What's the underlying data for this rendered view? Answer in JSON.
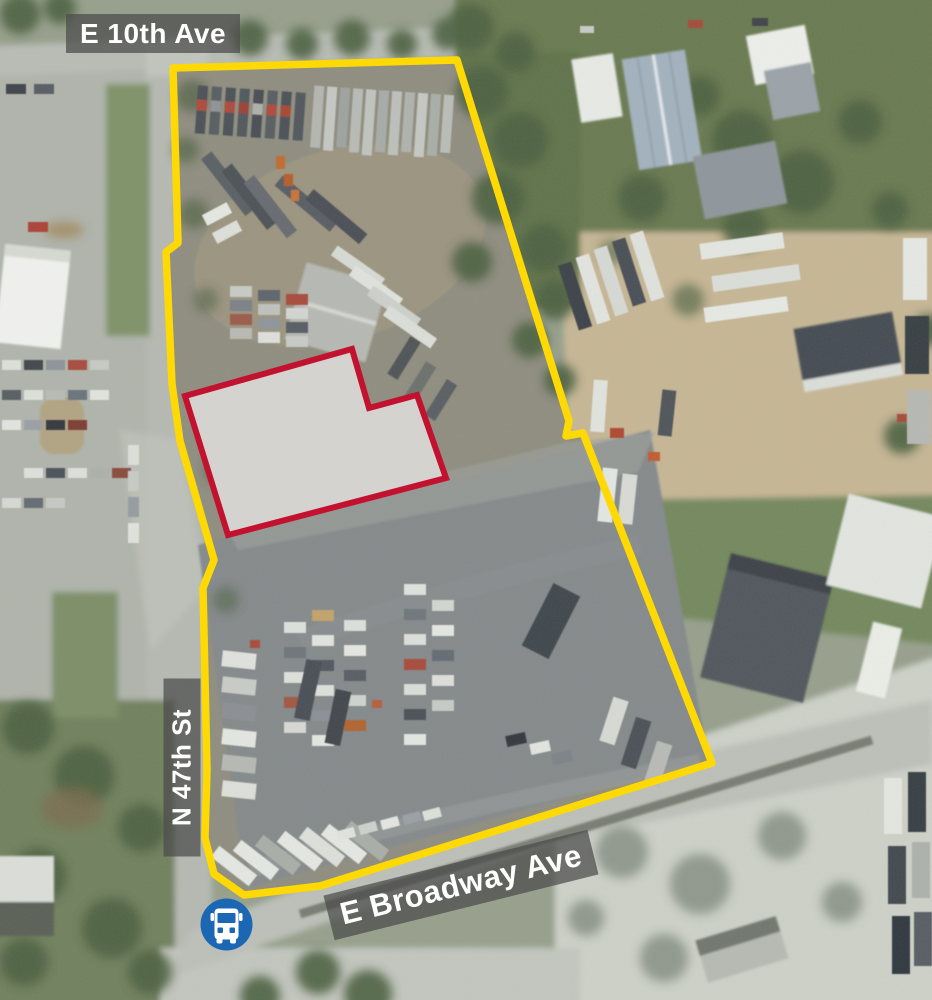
{
  "map": {
    "type": "aerial-satellite-property-map",
    "street_labels": {
      "top": "E 10th Ave",
      "left": "N 47th St",
      "bottom": "E Broadway Ave"
    },
    "overlays": {
      "property_boundary": {
        "color": "#FFD903",
        "points": "173,68 457,60 569,421 566,436 583,433 712,763 320,886 244,895 214,874 205,838 207,770 203,588 214,560 196,497 180,441 172,384 166,252 178,243"
      },
      "building_outline": {
        "color": "#C2122F",
        "fill": "#D4D3CF",
        "points": "185,396 352,349 369,408 417,395 446,478 228,535"
      },
      "bus_stop": {
        "color": "#1C67B4"
      }
    },
    "label_style": {
      "bg": "rgba(75,75,75,0.72)",
      "fg": "#FFFFFF"
    }
  }
}
